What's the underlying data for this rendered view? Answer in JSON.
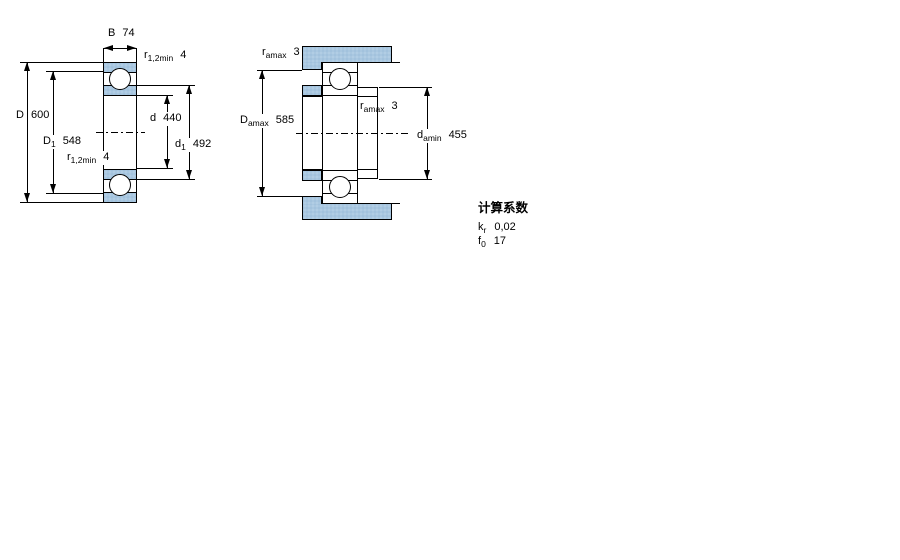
{
  "figure_left": {
    "dim_B": {
      "base": "B",
      "value": "74"
    },
    "dim_D": {
      "base": "D",
      "value": "600"
    },
    "dim_D1": {
      "base": "D",
      "sub": "1",
      "value": "548"
    },
    "dim_d": {
      "base": "d",
      "value": "440"
    },
    "dim_d1": {
      "base": "d",
      "sub": "1",
      "value": "492"
    },
    "dim_r_top": {
      "base": "r",
      "sub": "1,2min",
      "value": "4"
    },
    "dim_r_bottom": {
      "base": "r",
      "sub": "1,2min",
      "value": "4"
    }
  },
  "figure_right": {
    "dim_ra_top": {
      "base": "r",
      "sub": "amax",
      "value": "3"
    },
    "dim_ra_mid": {
      "base": "r",
      "sub": "amax",
      "value": "3"
    },
    "dim_Damax": {
      "base": "D",
      "sub": "amax",
      "value": "585"
    },
    "dim_damin": {
      "base": "d",
      "sub": "amin",
      "value": "455"
    }
  },
  "calculation_factors": {
    "heading": "计算系数",
    "rows": [
      {
        "base": "k",
        "sub": "r",
        "value": "0,02"
      },
      {
        "base": "f",
        "sub": "0",
        "value": "17"
      }
    ]
  },
  "colors": {
    "steel_fill": "#a9c7e0",
    "line": "#000000",
    "background": "#ffffff"
  }
}
